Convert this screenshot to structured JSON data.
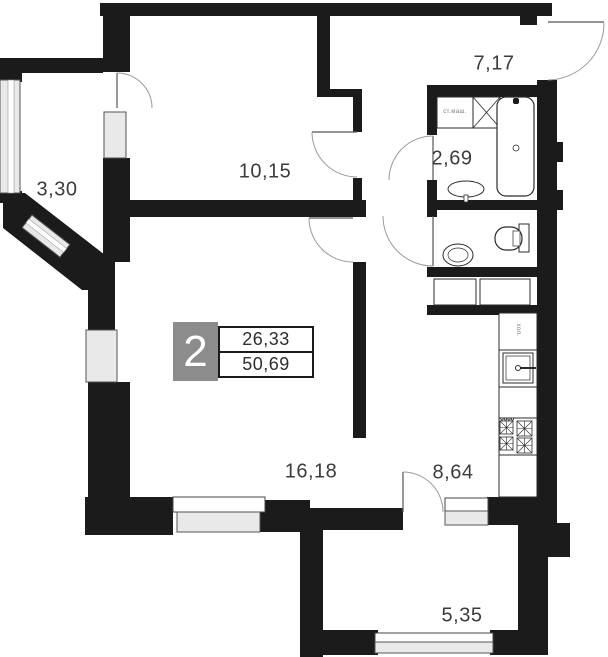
{
  "plan": {
    "apartment_badge": {
      "number": "2",
      "living_area": "26,33",
      "total_area": "50,69"
    },
    "rooms": [
      {
        "id": "loggia-left",
        "area_label": "3,30"
      },
      {
        "id": "bedroom",
        "area_label": "10,15"
      },
      {
        "id": "hallway",
        "area_label": "7,17"
      },
      {
        "id": "bathroom",
        "area_label": "2,69"
      },
      {
        "id": "living-room",
        "area_label": "16,18"
      },
      {
        "id": "kitchen",
        "area_label": "8,64"
      },
      {
        "id": "balcony-bottom",
        "area_label": "5,35"
      }
    ],
    "fixture_labels": {
      "washing_machine": "ст.маш.",
      "fridge": "хол."
    },
    "colors": {
      "wall": "#1b1b1b",
      "window_fill": "#e9e9e9",
      "badge_gray": "#8c8c8c",
      "arc": "#9a9a9a"
    }
  }
}
